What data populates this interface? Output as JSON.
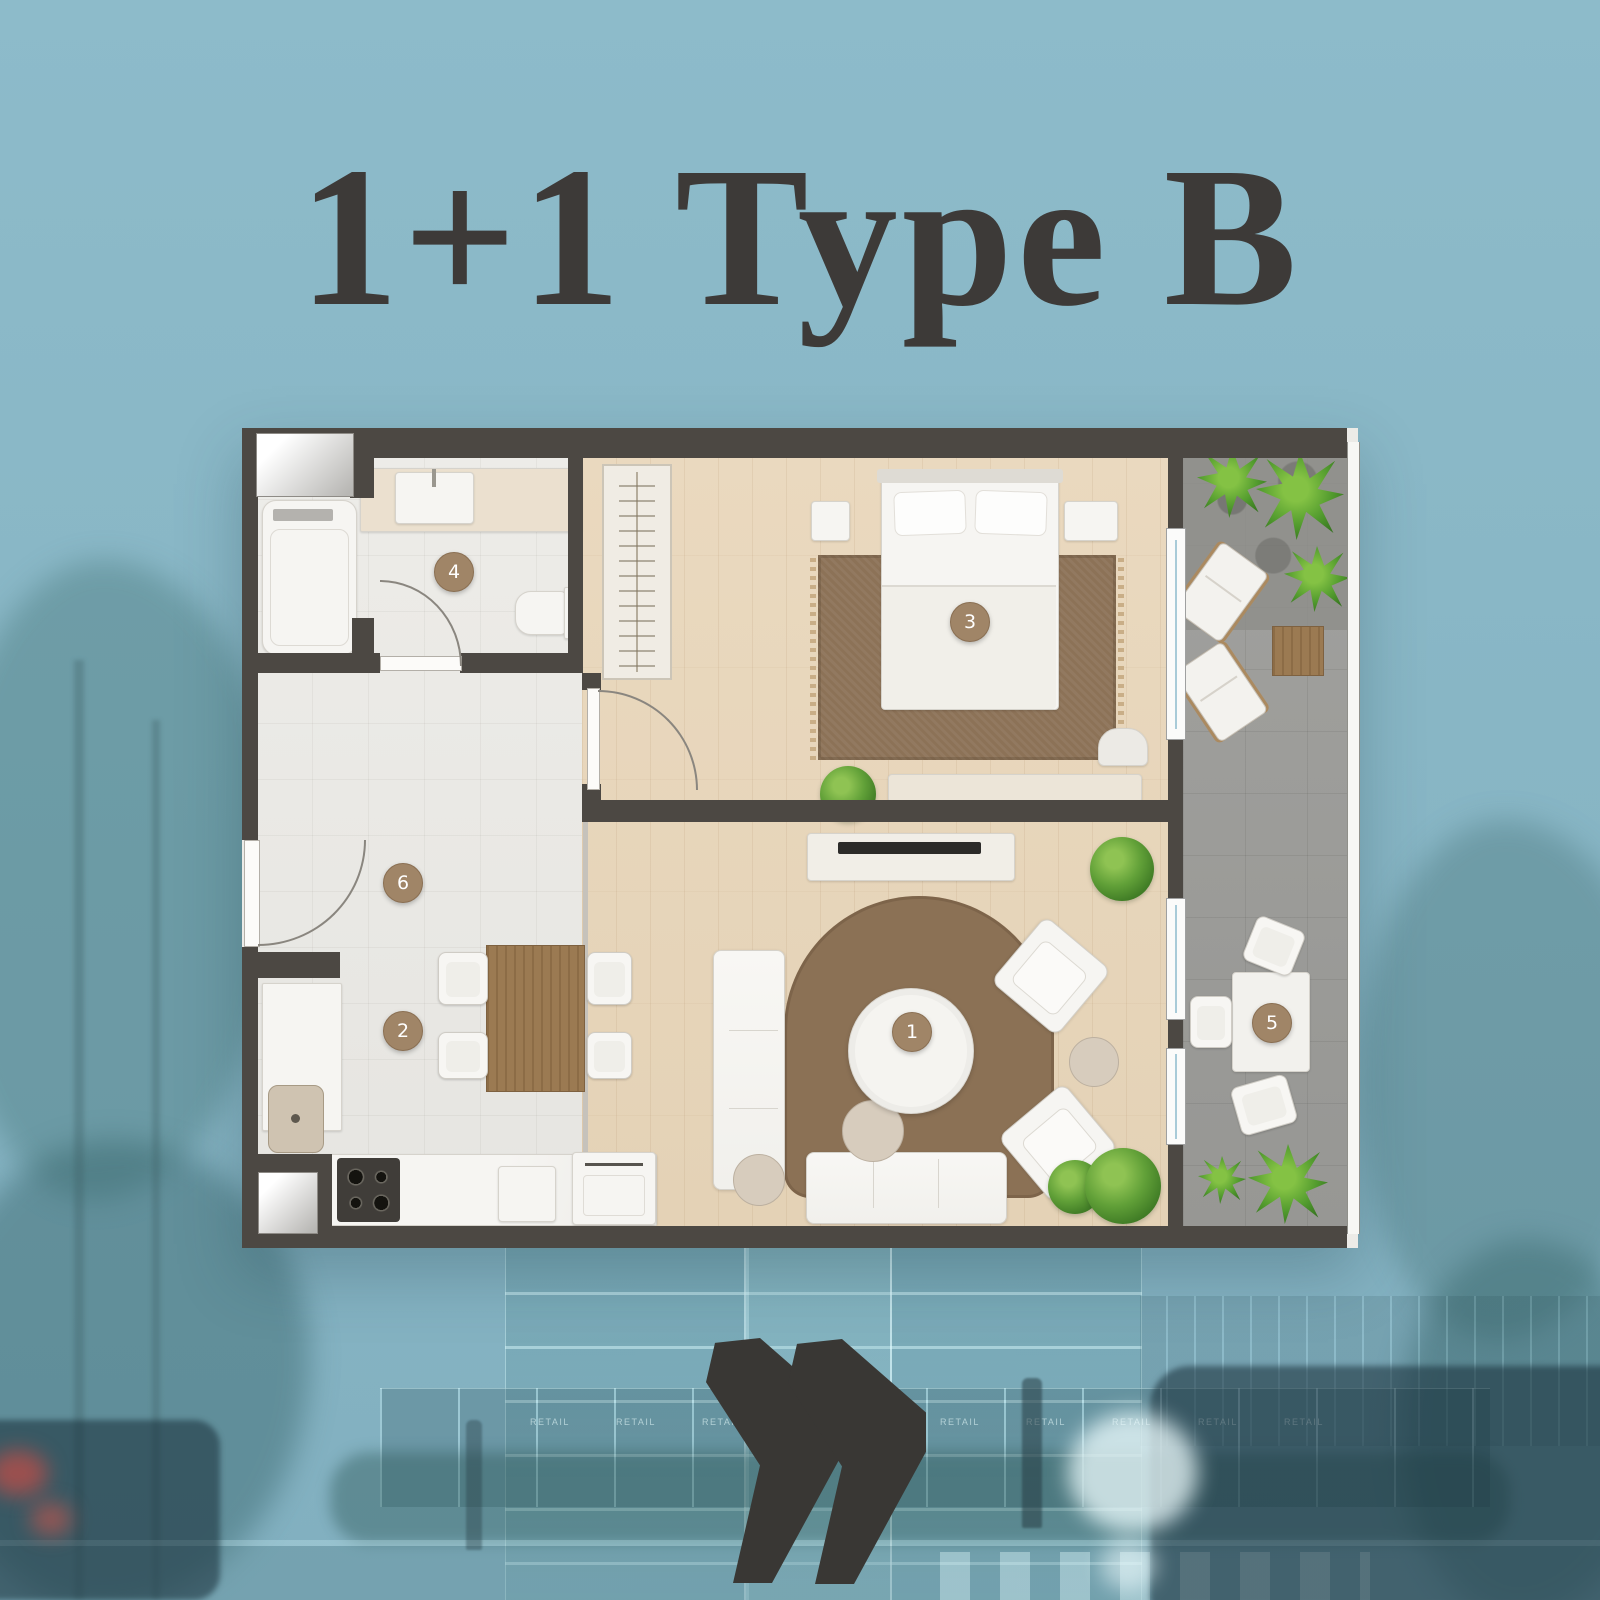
{
  "title": "1+1 Type B",
  "floor_plan": {
    "rooms": [
      {
        "label": "1"
      },
      {
        "label": "2"
      },
      {
        "label": "3"
      },
      {
        "label": "4"
      },
      {
        "label": "5"
      },
      {
        "label": "6"
      }
    ]
  },
  "background": {
    "retail_labels": [
      "RETAIL",
      "RETAIL",
      "RETAIL",
      "RETAIL",
      "RETAIL",
      "RETAIL",
      "RETAIL",
      "RETAIL",
      "RETAIL"
    ]
  },
  "colors": {
    "background_teal": "#88b6c5",
    "title_text": "#3d3a38",
    "wall": "#4c4843",
    "badge": "#a08567",
    "wood_floor": "#e7d7bd",
    "tile_floor": "#eae9e5",
    "balcony_floor": "#9c9c99",
    "rug": "#8c7257",
    "plant_green": "#579334",
    "logo": "#393734"
  }
}
